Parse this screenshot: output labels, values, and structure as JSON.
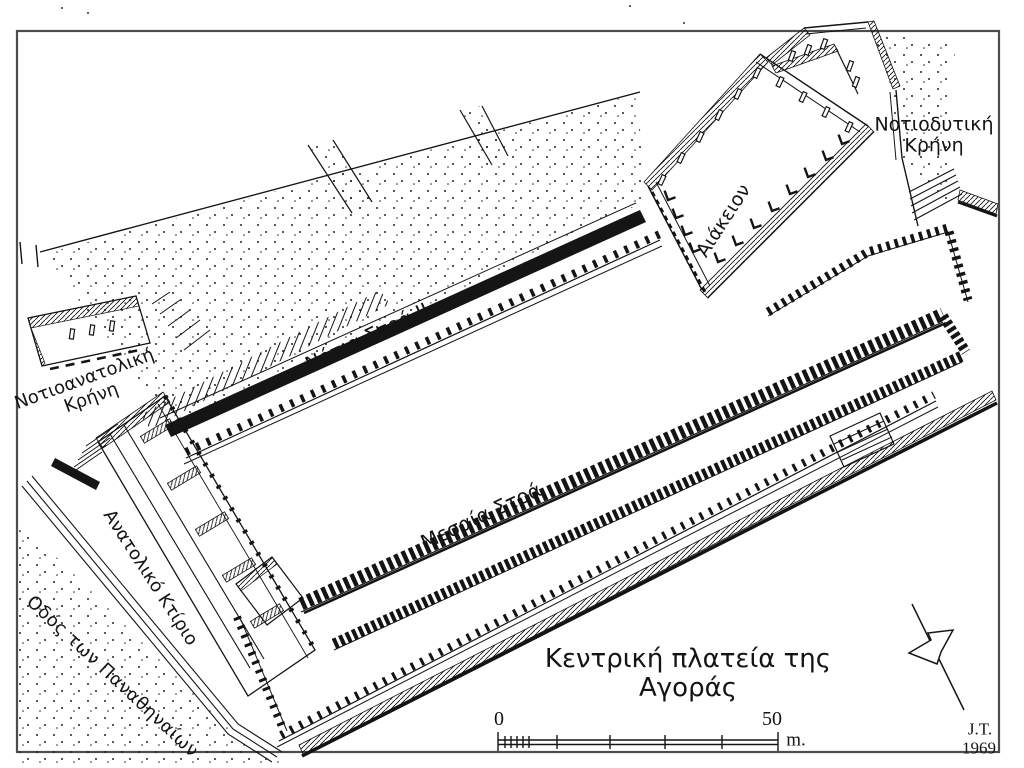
{
  "drawing": {
    "labels": {
      "southwest_fountain": "Νοτιοδυτική\nΚρήνη",
      "aiakeion": "Αιάκειον",
      "south_stoa_ii": "Νότια Στοά II",
      "southeast_fountain": "Νοτιοανατολική\nΚρήνη",
      "middle_stoa": "Μεσαία Στοά",
      "east_building": "Ανατολικό Κτίριο",
      "panathenaic_way": "Οδός των Παναθηναίων",
      "central_square": "Κεντρική πλατεία της Αγοράς"
    },
    "scale_bar": {
      "start": "0",
      "end": "50",
      "unit": "m."
    },
    "signature": {
      "initials": "J.T.",
      "year": "1969"
    },
    "colors": {
      "ink": "#141414",
      "paper": "#ffffff",
      "frame_border": "#4d4d4d"
    }
  }
}
